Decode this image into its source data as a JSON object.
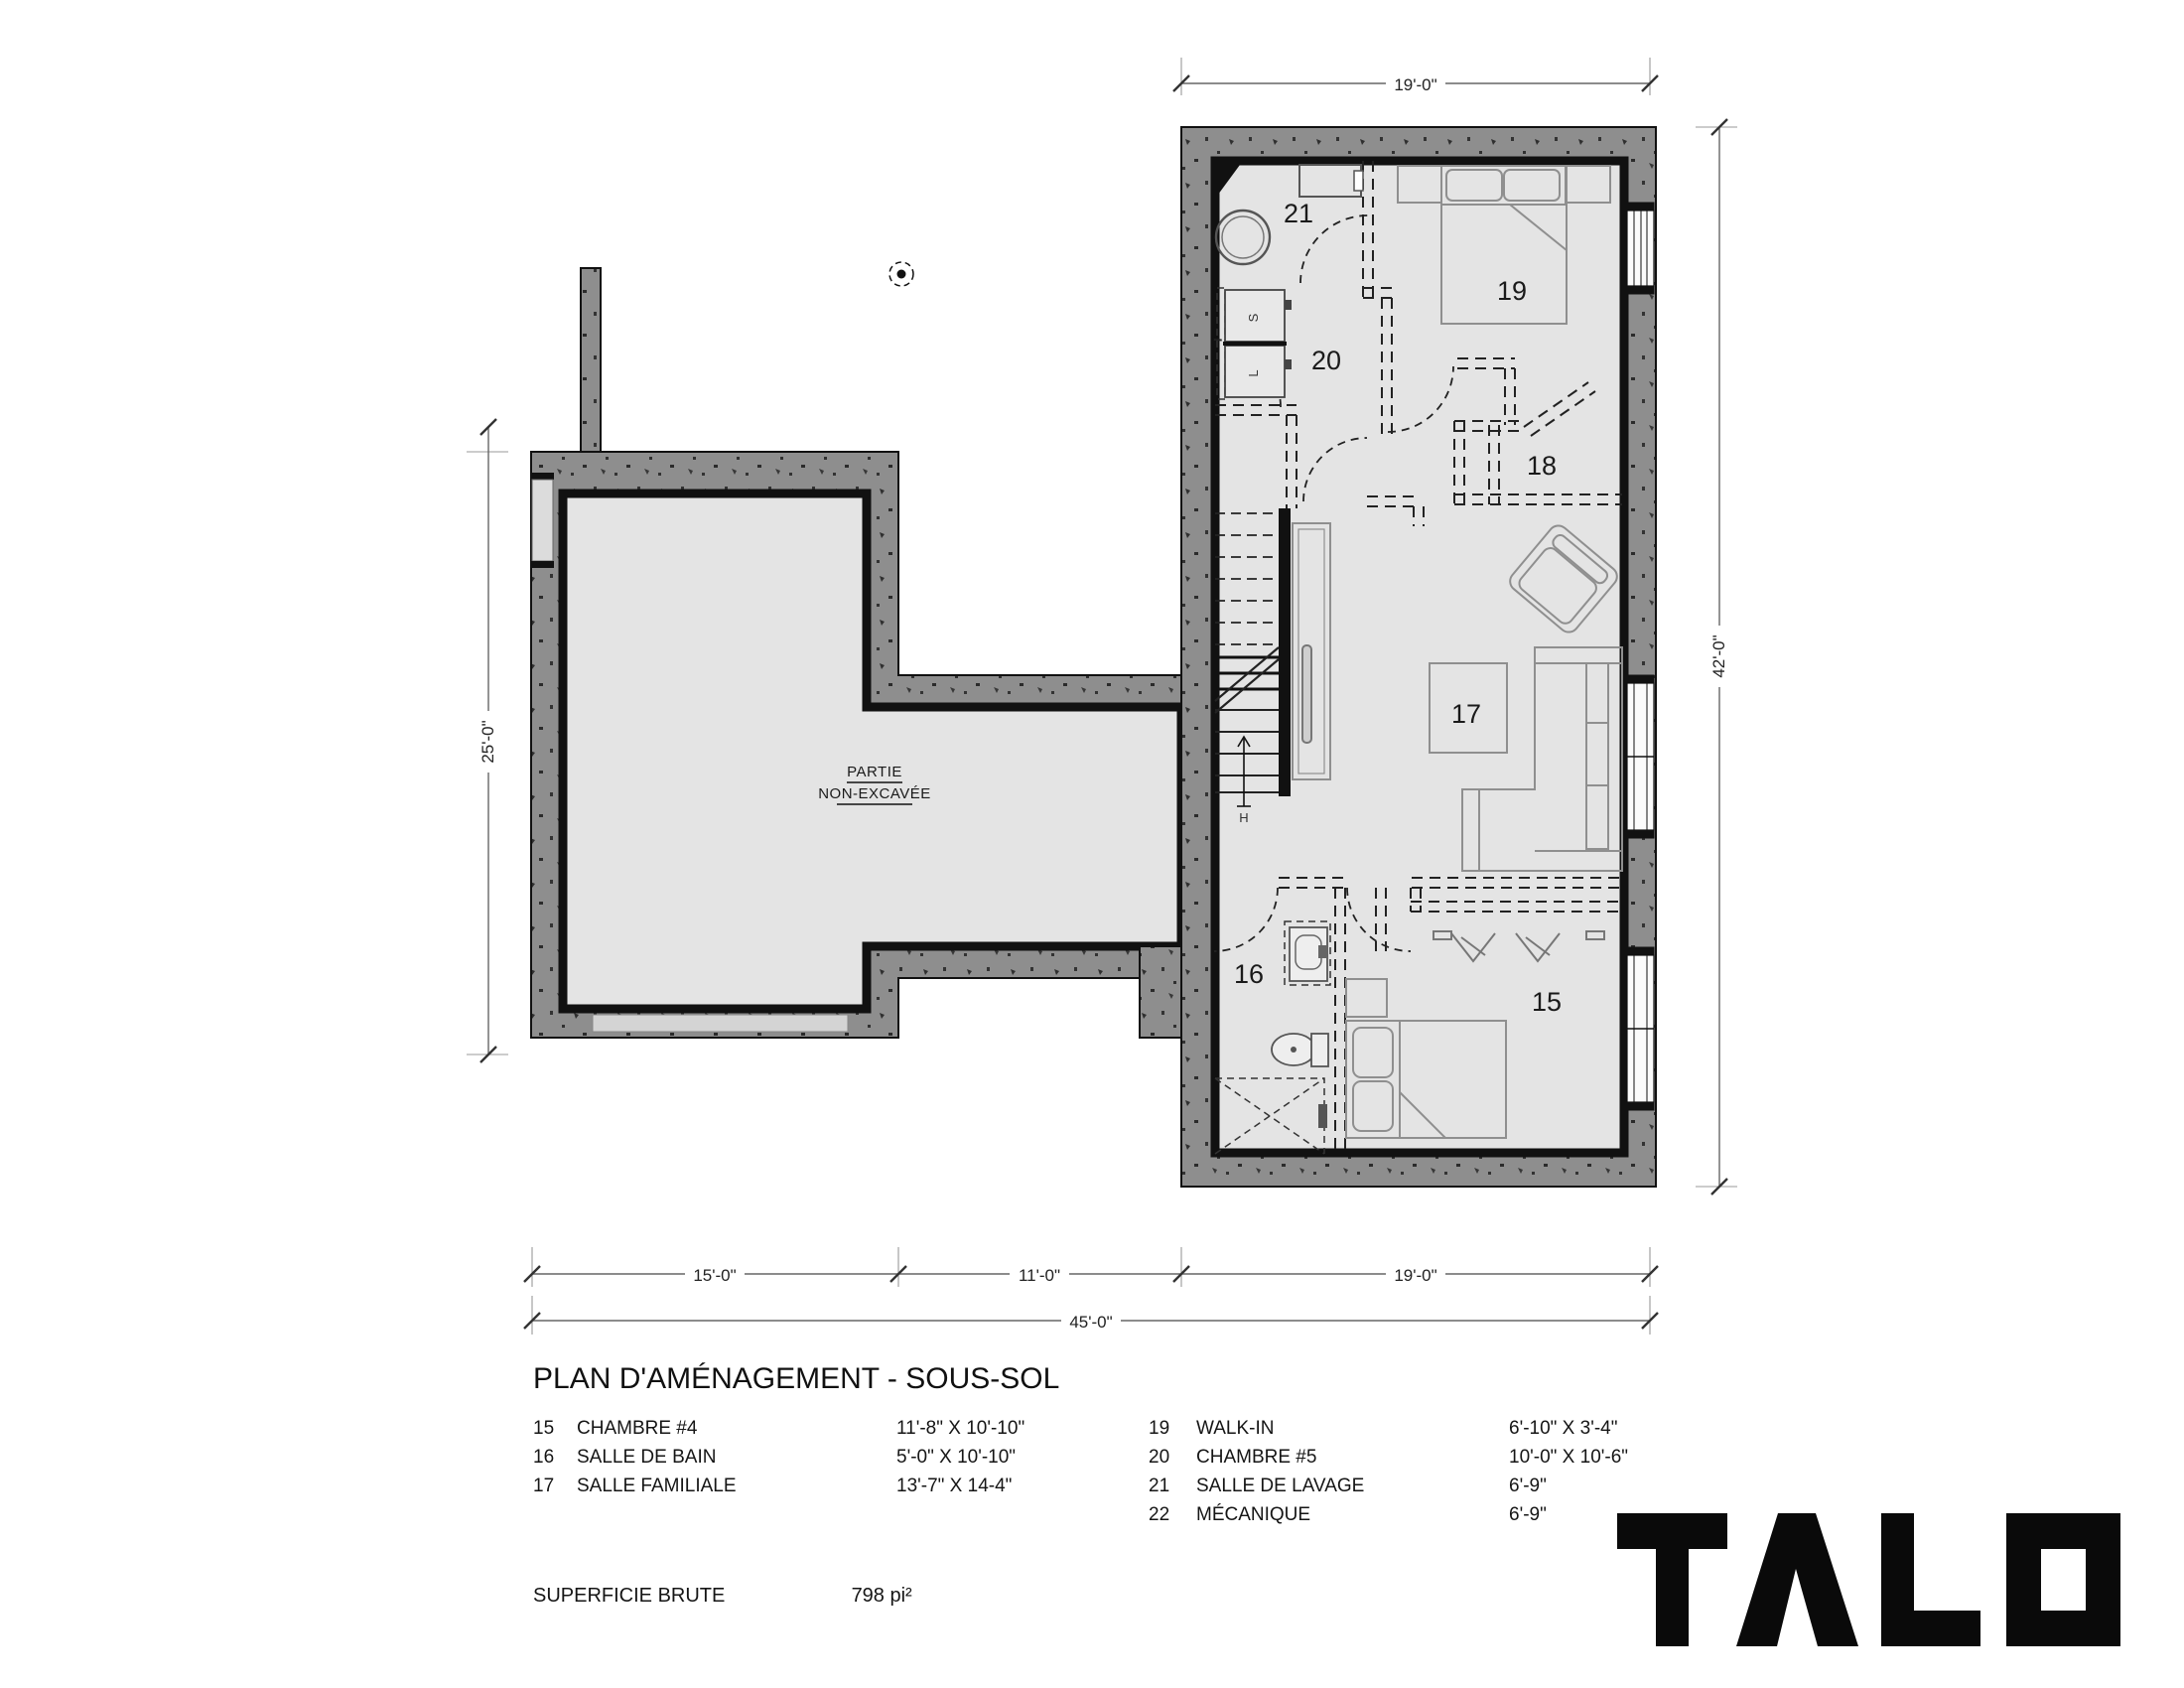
{
  "plan": {
    "non_excavated": {
      "line1": "PARTIE",
      "line2": "NON-EXCAVÉE"
    },
    "rooms": {
      "r15": "15",
      "r16": "16",
      "r17": "17",
      "r18": "18",
      "r19": "19",
      "r20": "20",
      "r21": "21"
    },
    "appliances": {
      "washer": "S",
      "dryer": "L"
    },
    "stair_mark": "H"
  },
  "dims": {
    "top": "19'-0\"",
    "left": "25'-0\"",
    "right": "42'-0\"",
    "bottom_segments": [
      "15'-0\"",
      "11'-0\"",
      "19'-0\""
    ],
    "bottom_total": "45'-0\""
  },
  "legend": {
    "title": "PLAN D'AMÉNAGEMENT - SOUS-SOL",
    "left": [
      {
        "num": "15",
        "name": "CHAMBRE #4",
        "dims": "11'-8\" X 10'-10\""
      },
      {
        "num": "16",
        "name": "SALLE DE BAIN",
        "dims": "5'-0\" X 10'-10\""
      },
      {
        "num": "17",
        "name": "SALLE FAMILIALE",
        "dims": "13'-7\" X 14-4\""
      }
    ],
    "right": [
      {
        "num": "19",
        "name": "WALK-IN",
        "dims": "6'-10\" X 3'-4\""
      },
      {
        "num": "20",
        "name": "CHAMBRE #5",
        "dims": "10'-0\" X 10'-6\""
      },
      {
        "num": "21",
        "name": "SALLE DE LAVAGE",
        "dims": "6'-9\""
      },
      {
        "num": "22",
        "name": "MÉCANIQUE",
        "dims": "6'-9\""
      }
    ],
    "area_label": "SUPERFICIE BRUTE",
    "area_value": "798 pi²"
  },
  "logo": {
    "name": "TALO"
  }
}
